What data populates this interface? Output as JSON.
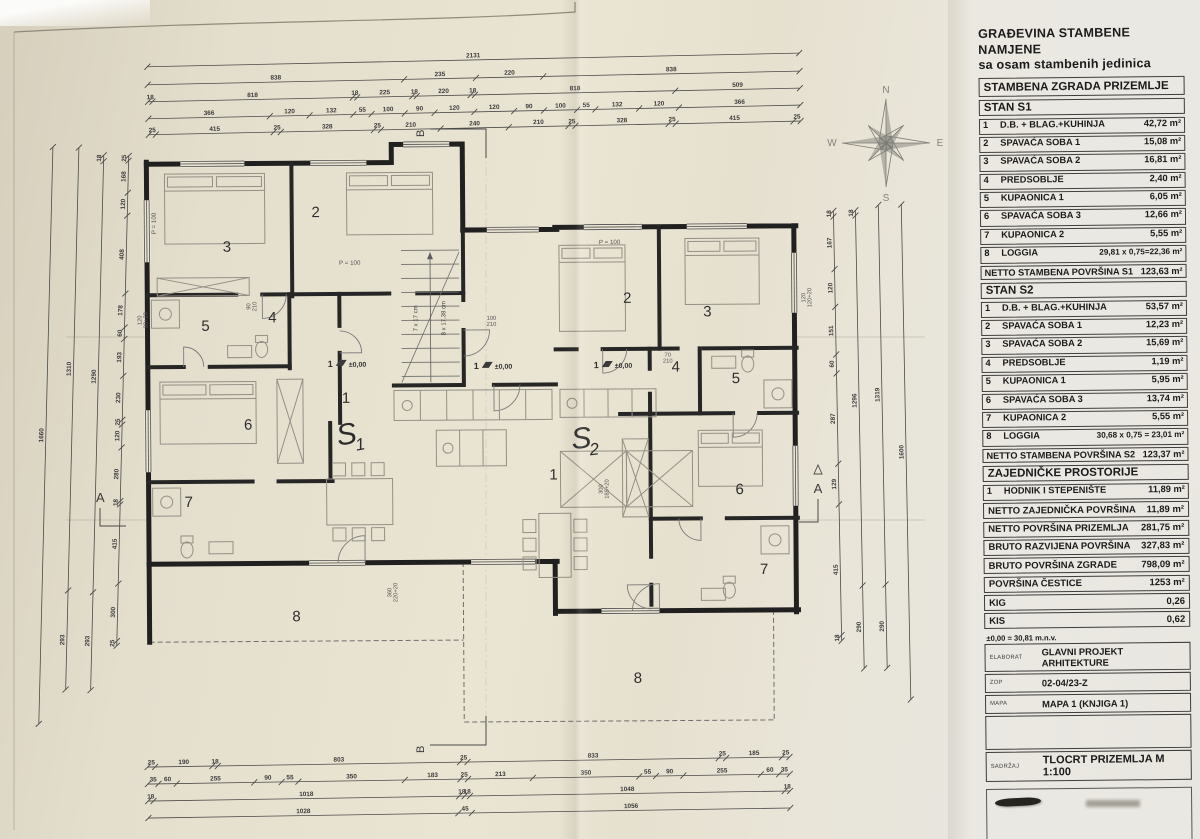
{
  "panel": {
    "title_line1": "GRAĐEVINA STAMBENE NAMJENE",
    "title_line2": "sa osam stambenih jedinica",
    "subtitle": "STAMBENA ZGRADA PRIZEMLJE",
    "s1": {
      "heading": "STAN S1",
      "rows": [
        {
          "num": "1",
          "label": "D.B. + BLAG.+KUHINJA",
          "value": "42,72 m²"
        },
        {
          "num": "2",
          "label": "SPAVAĆA SOBA 1",
          "value": "15,08 m²"
        },
        {
          "num": "3",
          "label": "SPAVAĆA SOBA 2",
          "value": "16,81 m²"
        },
        {
          "num": "4",
          "label": "PREDSOBLJE",
          "value": "2,40 m²"
        },
        {
          "num": "5",
          "label": "KUPAONICA 1",
          "value": "6,05 m²"
        },
        {
          "num": "6",
          "label": "SPAVAĆA SOBA 3",
          "value": "12,66 m²"
        },
        {
          "num": "7",
          "label": "KUPAONICA 2",
          "value": "5,55 m²"
        },
        {
          "num": "8",
          "label": "LOGGIA",
          "value": "29,81 x 0,75=22,36 m²"
        }
      ],
      "netto_label": "NETTO STAMBENA POVRŠINA S1",
      "netto_value": "123,63 m²"
    },
    "s2": {
      "heading": "STAN S2",
      "rows": [
        {
          "num": "1",
          "label": "D.B. + BLAG.+KUHINJA",
          "value": "53,57 m²"
        },
        {
          "num": "2",
          "label": "SPAVAĆA SOBA 1",
          "value": "12,23 m²"
        },
        {
          "num": "3",
          "label": "SPAVAĆA SOBA 2",
          "value": "15,69 m²"
        },
        {
          "num": "4",
          "label": "PREDSOBLJE",
          "value": "1,19 m²"
        },
        {
          "num": "5",
          "label": "KUPAONICA 1",
          "value": "5,95 m²"
        },
        {
          "num": "6",
          "label": "SPAVAĆA SOBA 3",
          "value": "13,74 m²"
        },
        {
          "num": "7",
          "label": "KUPAONICA 2",
          "value": "5,55 m²"
        },
        {
          "num": "8",
          "label": "LOGGIA",
          "value": "30,68 x 0,75 = 23,01 m²"
        }
      ],
      "netto_label": "NETTO STAMBENA POVRŠINA S2",
      "netto_value": "123,37 m²"
    },
    "common": {
      "heading": "ZAJEDNIČKE PROSTORIJE",
      "row": {
        "num": "1",
        "label": "HODNIK I STEPENIŠTE",
        "value": "11,89 m²"
      }
    },
    "summary": [
      {
        "label": "NETTO ZAJEDNIČKA POVRŠINA",
        "value": "11,89 m²"
      },
      {
        "label": "NETTO POVRŠINA PRIZEMLJA",
        "value": "281,75 m²"
      },
      {
        "label": "BRUTO RAZVIJENA POVRŠINA",
        "value": "327,83 m²"
      },
      {
        "label": "BRUTO POVRŠINA ZGRADE",
        "value": "798,09 m²"
      },
      {
        "label": "POVRŠINA ČESTICE",
        "value": "1253 m²"
      },
      {
        "label": "KIG",
        "value": "0,26"
      },
      {
        "label": "KIS",
        "value": "0,62"
      }
    ],
    "level_note": "±0,00 = 30,81 m.n.v.",
    "info": [
      {
        "key": "ELABORAT",
        "value": "GLAVNI PROJEKT ARHITEKTURE"
      },
      {
        "key": "ZOP",
        "value": "02-04/23-Z"
      },
      {
        "key": "MAPA",
        "value": "MAPA 1 (KNJIGA 1)"
      }
    ],
    "sadrzaj_key": "SADRŽAJ",
    "sadrzaj_value": "TLOCRT PRIZEMLJA M 1:100"
  },
  "compass": {
    "n": "N",
    "e": "E",
    "s": "S",
    "w": "W"
  },
  "plan": {
    "room_numbers": [
      "1",
      "2",
      "3",
      "4",
      "5",
      "6",
      "7",
      "8"
    ],
    "unit1": "S1",
    "unit2": "S2",
    "level_mark": "±0,00",
    "window_label": "P = 100",
    "stair_note1": "7 x 17 cm",
    "stair_note2": "8 x 17,38 cm",
    "section_a": "A",
    "section_b": "B",
    "door_labels": [
      [
        "100",
        "210"
      ],
      [
        "90",
        "210"
      ],
      [
        "70",
        "210"
      ],
      [
        "360",
        "220+20"
      ],
      [
        "300",
        "185+20"
      ],
      [
        "120",
        "120+20"
      ],
      [
        "120",
        "90+20"
      ]
    ],
    "dims": {
      "top": [
        [
          "2131"
        ],
        [
          "838",
          "235",
          "220",
          "838"
        ],
        [
          "18",
          "818",
          "18",
          "225",
          "18",
          "220",
          "18",
          "818",
          "509"
        ],
        [
          "366",
          "120",
          "132",
          "55",
          "100",
          "90",
          "120",
          "120",
          "90",
          "100",
          "55",
          "132",
          "120",
          "366"
        ],
        [
          "25",
          "415",
          "25",
          "328",
          "25",
          "210",
          "240",
          "210",
          "25",
          "328",
          "25",
          "415",
          "25"
        ]
      ],
      "bottom": [
        [
          "25",
          "190",
          "18",
          "803",
          "25",
          "833",
          "25",
          "185",
          "25"
        ],
        [
          "35",
          "60",
          "255",
          "90",
          "55",
          "350",
          "183",
          "25",
          "213",
          "350",
          "55",
          "90",
          "255",
          "60",
          "35"
        ],
        [
          "18",
          "1018",
          "18",
          "18",
          "1048",
          "18"
        ],
        [
          "1028",
          "45",
          "1056"
        ]
      ],
      "left": [
        [
          "1660"
        ],
        [
          "1310",
          "293"
        ],
        [
          "18",
          "1290",
          "293"
        ],
        [
          "25",
          "168",
          "120",
          "408",
          "178",
          "60",
          "193",
          "230",
          "25",
          "120",
          "280",
          "18",
          "415",
          "300",
          "25"
        ]
      ],
      "right": [
        [
          "1600"
        ],
        [
          "1319",
          "290"
        ],
        [
          "18",
          "1296",
          "290"
        ],
        [
          "18",
          "167",
          "120",
          "151",
          "60",
          "287",
          "129",
          "415",
          "18"
        ]
      ]
    }
  }
}
